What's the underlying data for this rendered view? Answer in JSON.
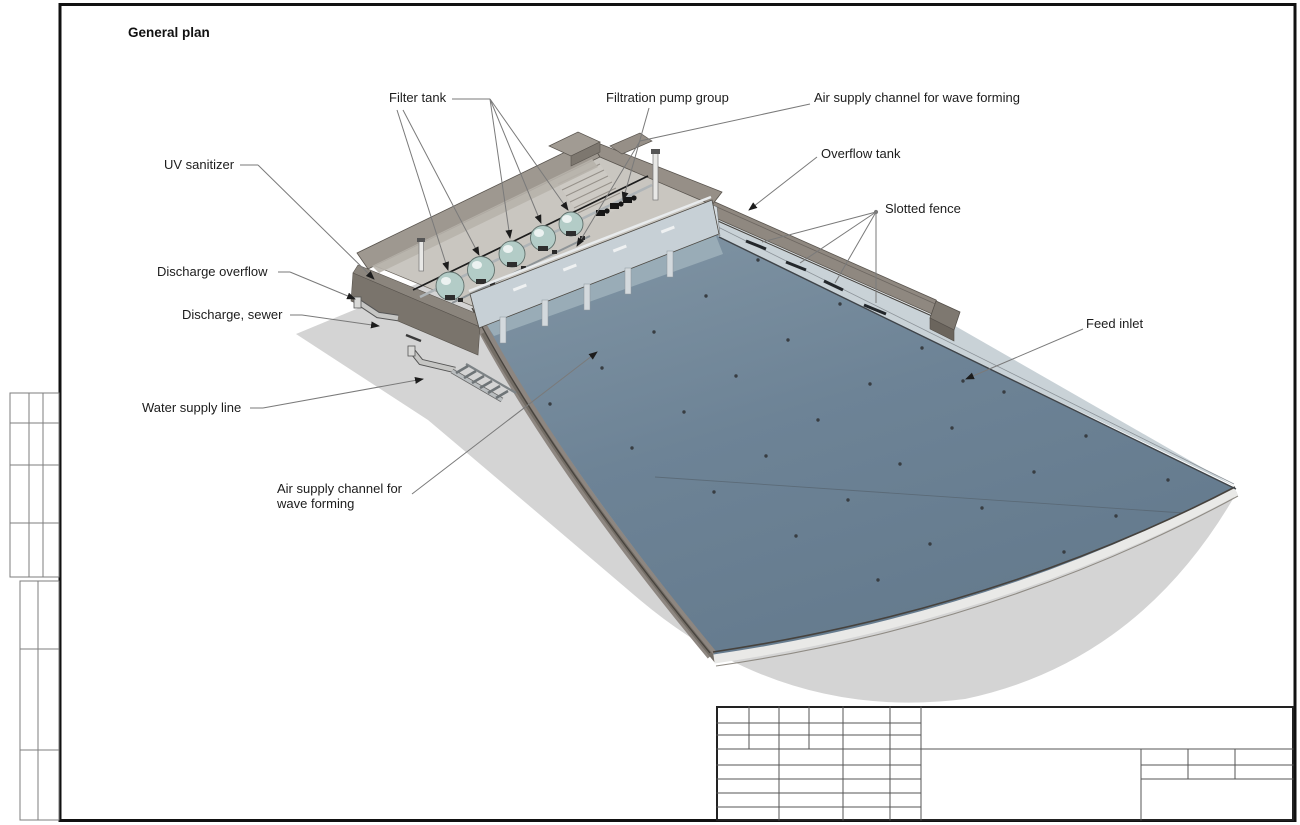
{
  "sheet": {
    "title": "General plan"
  },
  "callouts": {
    "filter_tank": "Filter tank",
    "filtration_pump_group": "Filtration pump group",
    "air_supply_channel_top": "Air supply channel for wave forming",
    "overflow_tank": "Overflow tank",
    "slotted_fence": "Slotted fence",
    "uv_sanitizer": "UV sanitizer",
    "discharge_overflow": "Discharge overflow",
    "discharge_sewer": "Discharge, sewer",
    "water_supply_line": "Water supply line",
    "air_supply_channel_bottom": "Air supply channel for wave forming",
    "feed_inlet": "Feed inlet"
  },
  "title_block": {
    "cells": "empty"
  },
  "colors": {
    "water": "#6d8396",
    "water_light": "#8ba0ae",
    "concrete_top": "#9d978f",
    "concrete_face": "#7b756d",
    "concrete_mid": "#8c867e",
    "panel_wall": "#c7d0d6",
    "ledge_band": "#c9d2d7",
    "shadow": "#d4d4d4",
    "tank_dome": "#b3ccc7",
    "floor": "#c9c6c0",
    "leader_line": "#7a7a7a",
    "frame_line": "#1a1a1a"
  }
}
